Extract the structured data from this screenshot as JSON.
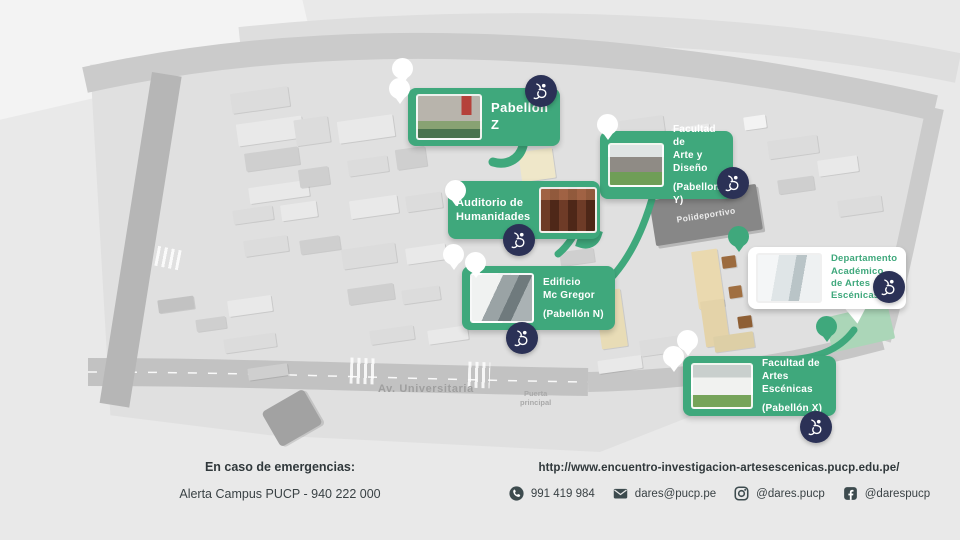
{
  "colors": {
    "green": "#3fa87c",
    "navy": "#2b3156",
    "icon_dark": "#3d4b4e"
  },
  "map": {
    "labels": {
      "avenue": "Av. Universitaria",
      "gate_line1": "Puerta",
      "gate_line2": "principal",
      "sports_center": "Polideportivo"
    },
    "callouts": [
      {
        "id": "pabellon-z",
        "lines": [
          "Pabellón Z"
        ]
      },
      {
        "id": "facultad-arte-diseno",
        "lines": [
          "Facultad de",
          "Arte y Diseño",
          "(Pabellon Y)"
        ]
      },
      {
        "id": "auditorio-humanidades",
        "lines": [
          "Auditorio de",
          "Humanidades"
        ]
      },
      {
        "id": "edificio-mc-gregor",
        "lines": [
          "Edificio",
          "Mc Gregor",
          "(Pabellón N)"
        ]
      },
      {
        "id": "departamento-artes-escenicas",
        "lines": [
          "Departamento",
          "Académico",
          "de Artes",
          "Escénicas"
        ]
      },
      {
        "id": "facultad-artes-escenicas",
        "lines": [
          "Facultad de",
          "Artes Escénicas",
          "(Pabellón X)"
        ]
      }
    ]
  },
  "footer": {
    "emergency_title": "En caso de emergencias:",
    "emergency_line": "Alerta Campus PUCP - 940 222 000",
    "website": "http://www.encuentro-investigacion-artesescenicas.pucp.edu.pe/",
    "contacts": [
      {
        "icon": "whatsapp-icon",
        "label": "991 419 984"
      },
      {
        "icon": "email-icon",
        "label": "dares@pucp.pe"
      },
      {
        "icon": "instagram-icon",
        "label": "@dares.pucp"
      },
      {
        "icon": "facebook-icon",
        "label": "@darespucp"
      }
    ]
  }
}
